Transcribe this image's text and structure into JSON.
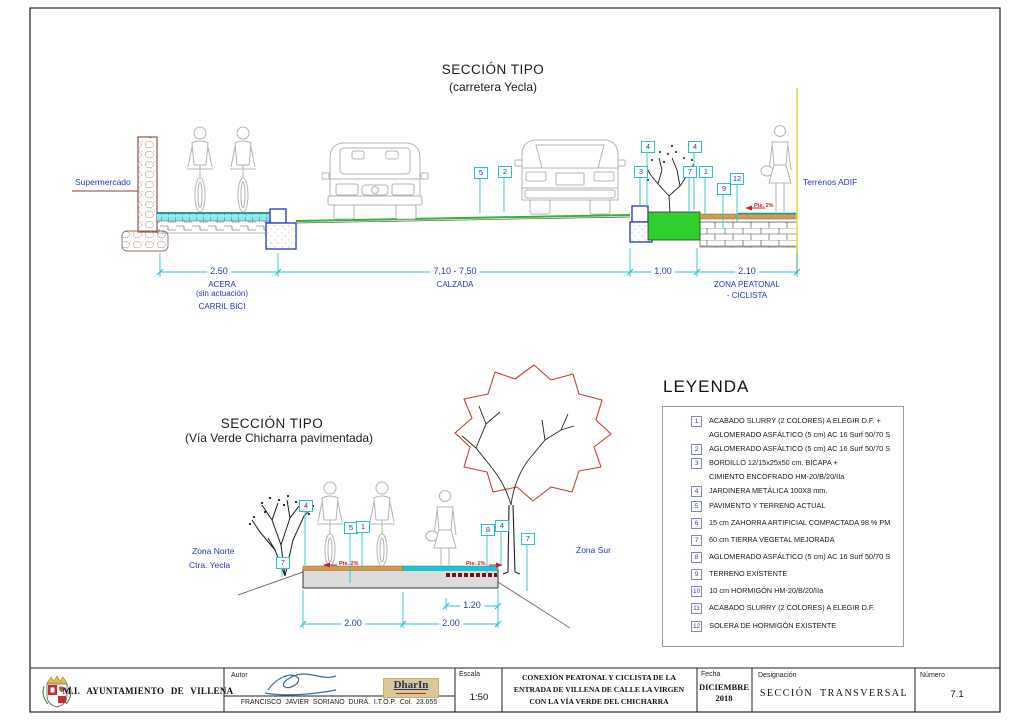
{
  "colors": {
    "dimension_cyan": "#25c3d8",
    "label_blue": "#2a35c0",
    "road_green": "#2db52d",
    "planter_green": "#2ed02e",
    "adif_yellow": "#e6d84a",
    "slope_red": "#cf1f1f",
    "paving_tan": "#d19a55",
    "slab_gray": "#dcdcdc"
  },
  "top_section": {
    "title": "SECCIÓN TIPO",
    "subtitle": "(carretera Yecla)",
    "label_supermercado": "Supermercado",
    "label_terrenos_adif": "Terrenos ADIF",
    "slope_label": "Pte. 2%",
    "markers": {
      "m5": "5",
      "m2": "2",
      "m4a": "4",
      "m3": "3",
      "m4b": "4",
      "m7": "7",
      "m1": "1",
      "m9": "9",
      "m12": "12"
    },
    "dims": {
      "d1": {
        "value": "2.50",
        "cap1": "ACERA",
        "cap2": "(sin actuación)",
        "cap3": "CARRIL BICI"
      },
      "d2": {
        "value": "7,10 - 7,50",
        "cap1": "CALZADA"
      },
      "d3": {
        "value": "1.00"
      },
      "d4": {
        "value": "2.10",
        "cap1": "ZONA PEATONAL",
        "cap2": "- CICLISTA"
      }
    }
  },
  "bottom_section": {
    "title": "SECCIÓN TIPO",
    "subtitle": "(Vía Verde Chicharra pavimentada)",
    "label_zona_norte_1": "Zona Norte",
    "label_zona_norte_2": "Ctra. Yecla",
    "label_zona_sur": "Zona Sur",
    "slope_label": "Pte. 2%",
    "markers": {
      "m7l": "7",
      "m4l": "4",
      "m5": "5",
      "m1": "1",
      "m8": "8",
      "m4r": "4",
      "m7r": "7"
    },
    "dims": {
      "d1": "2.00",
      "d2": "2.00",
      "d3": "1.20"
    }
  },
  "legend": {
    "title": "LEYENDA",
    "items": [
      {
        "num": "1",
        "lines": [
          "ACABADO SLURRY (2 COLORES) A ELEGIR D.F. +",
          "AGLOMERADO ASFÁLTICO (5 cm) AC 16 Surf 50/70 S"
        ]
      },
      {
        "num": "2",
        "lines": [
          "AGLOMERADO ASFÁLTICO (5 cm) AC 16 Surf 50/70 S"
        ]
      },
      {
        "num": "3",
        "lines": [
          "BORDILLO 12/15x25x50 cm. BICAPA +",
          "CIMIENTO ENCOFRADO HM-20/B/20/IIa"
        ]
      },
      {
        "num": "4",
        "lines": [
          "JARDINERA METÁLICA 100X8 mm."
        ]
      },
      {
        "num": "5",
        "lines": [
          "PAVIMENTO Y TERRENO ACTUAL"
        ]
      },
      {
        "num": "6",
        "lines": [
          "15 cm ZAHORRA ARTIFICIAL COMPACTADA 98 % PM"
        ]
      },
      {
        "num": "7",
        "lines": [
          "60 cm TIERRA VEGETAL MEJORADA"
        ]
      },
      {
        "num": "8",
        "lines": [
          "AGLOMERADO ASFÁLTICO (5 cm) AC 16 Surf 50/70 S"
        ]
      },
      {
        "num": "9",
        "lines": [
          "TERRENO EXISTENTE"
        ]
      },
      {
        "num": "10",
        "lines": [
          "10 cm HORMIGÓN HM-20/B/20/IIa"
        ]
      },
      {
        "num": "11",
        "lines": [
          "ACABADO SLURRY (2 COLORES) A ELEGIR D.F."
        ]
      },
      {
        "num": "12",
        "lines": [
          "SOLERA DE HORMIGÓN EXISTENTE"
        ]
      }
    ]
  },
  "title_block": {
    "municipality": "M.I. AYUNTAMIENTO DE VILLENA",
    "author_label": "Autor",
    "author_name": "FRANCISCO JAVIER SORIANO DURÁ.  I.T.O.P.  Col.  23.055",
    "logo_text": "DharIn",
    "scale_label": "Escala",
    "scale_value": "1:50",
    "project_title_line1": "CONEXIÓN PEATONAL Y CICLISTA DE LA",
    "project_title_line2": "ENTRADA DE VILLENA DE CALLE LA VIRGEN",
    "project_title_line3": "CON LA VÍA VERDE DEL CHICHARRA",
    "date_label": "Fecha",
    "date_month": "DICIEMBRE",
    "date_year": "2018",
    "designation_label": "Designación",
    "designation_value": "SECCIÓN TRANSVERSAL",
    "number_label": "Número",
    "number_value": "7.1"
  }
}
